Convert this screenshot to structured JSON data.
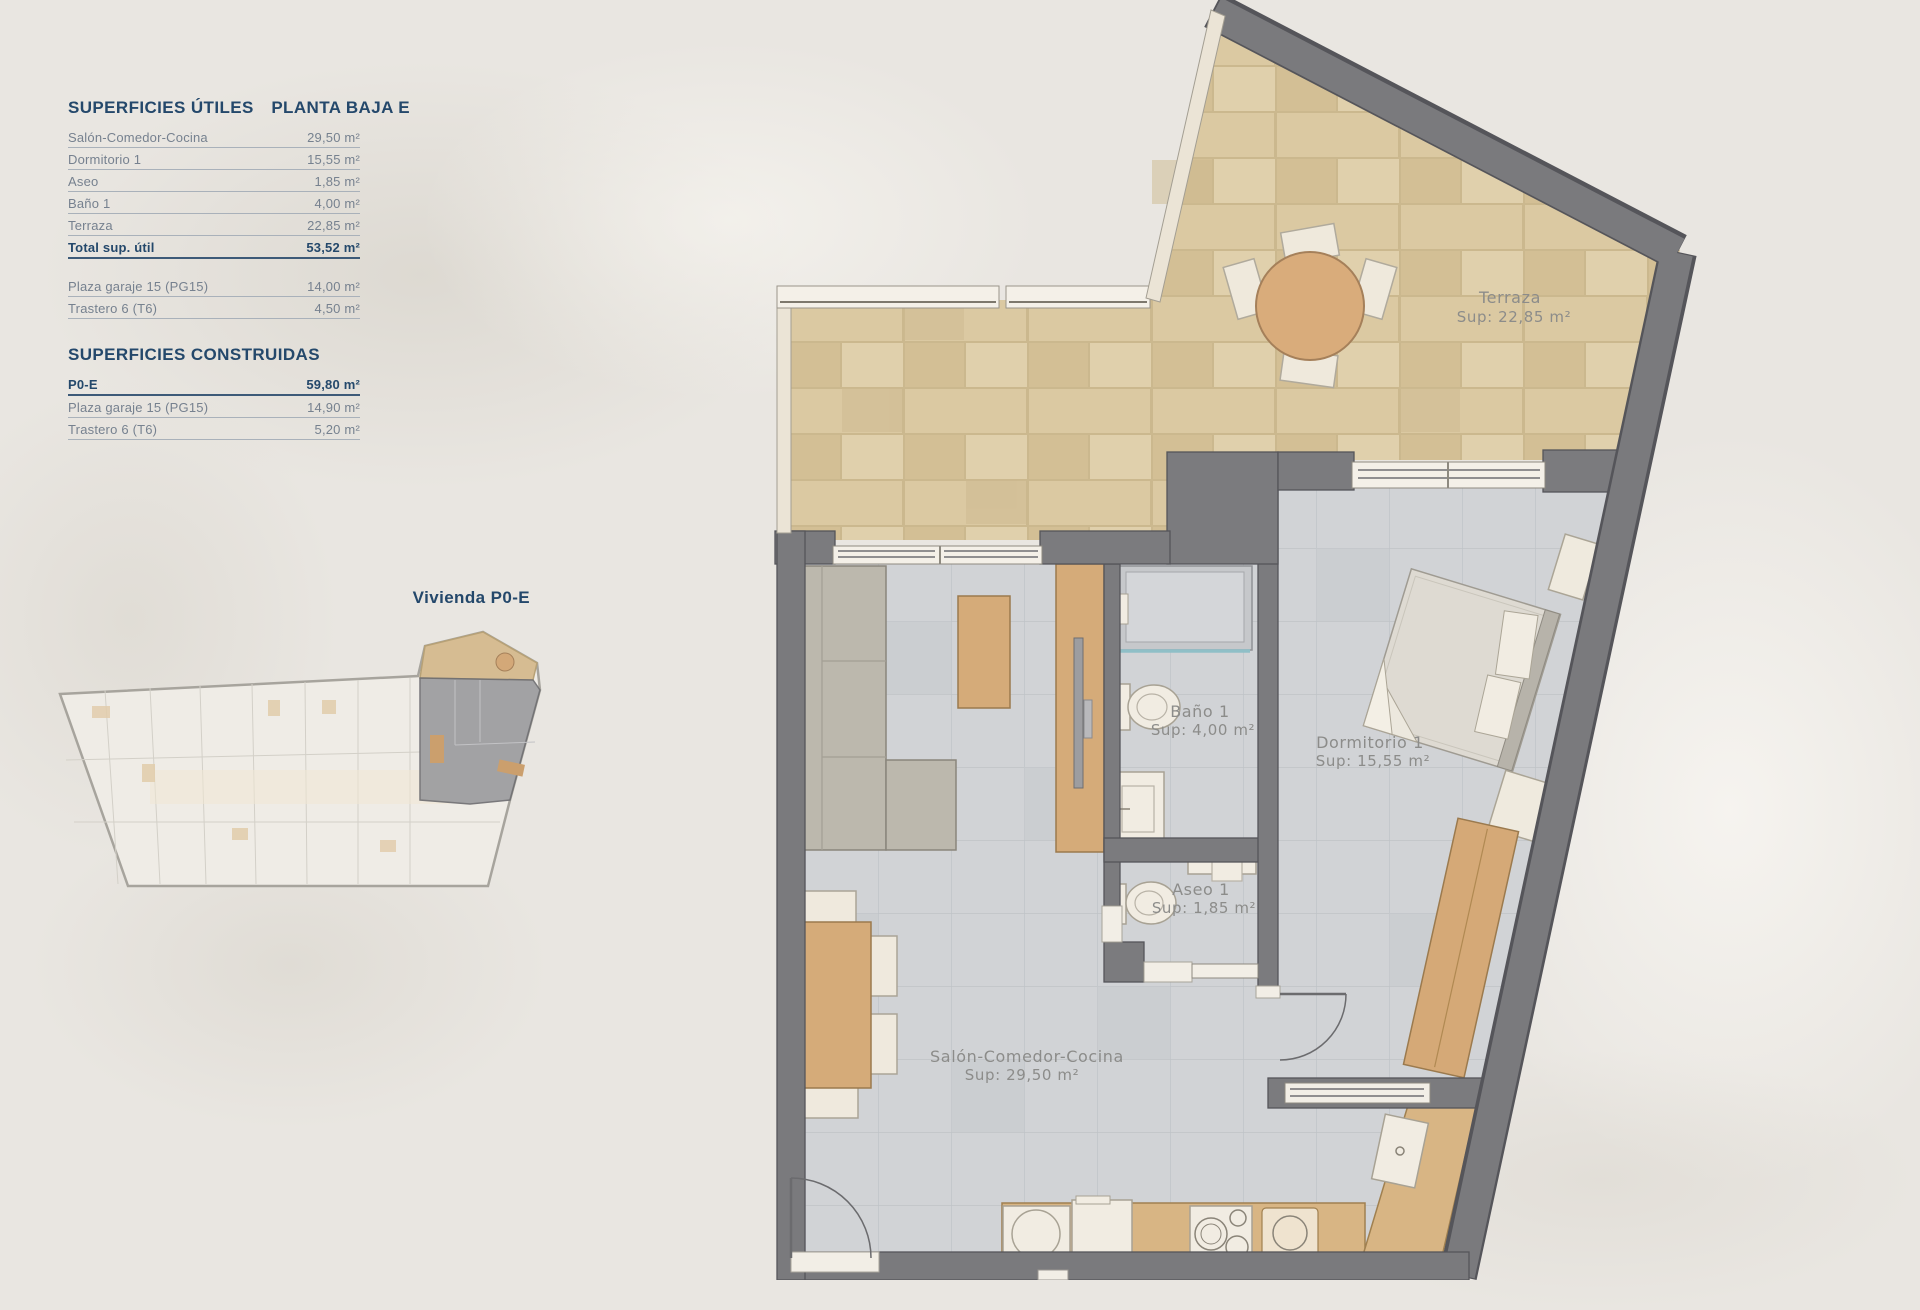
{
  "tables": {
    "utiles": {
      "title": "SUPERFICIES ÚTILES",
      "plan_label": "PLANTA BAJA E",
      "rows": [
        {
          "label": "Salón-Comedor-Cocina",
          "value": "29,50 m²"
        },
        {
          "label": "Dormitorio 1",
          "value": "15,55 m²"
        },
        {
          "label": "Aseo",
          "value": "1,85 m²"
        },
        {
          "label": "Baño 1",
          "value": "4,00 m²"
        },
        {
          "label": "Terraza",
          "value": "22,85 m²"
        }
      ],
      "total": {
        "label": "Total sup. útil",
        "value": "53,52 m²"
      },
      "annex_rows": [
        {
          "label": "Plaza garaje 15 (PG15)",
          "value": "14,00 m²"
        },
        {
          "label": "Trastero 6 (T6)",
          "value": "4,50 m²"
        }
      ]
    },
    "construidas": {
      "title": "SUPERFICIES CONSTRUIDAS",
      "main_row": {
        "label": "P0-E",
        "value": "59,80 m²"
      },
      "rows": [
        {
          "label": "Plaza garaje 15 (PG15)",
          "value": "14,90 m²"
        },
        {
          "label": "Trastero 6 (T6)",
          "value": "5,20 m²"
        }
      ]
    }
  },
  "unit_overview": {
    "caption": "Vivienda P0-E"
  },
  "plan": {
    "rooms": {
      "terraza": {
        "name": "Terraza",
        "area": "Sup: 22,85 m²"
      },
      "banyo": {
        "name": "Baño 1",
        "area": "Sup: 4,00 m²"
      },
      "dormitorio": {
        "name": "Dormitorio 1",
        "area": "Sup: 15,55 m²"
      },
      "aseo": {
        "name": "Aseo 1",
        "area": "Sup: 1,85 m²"
      },
      "salon": {
        "name": "Salón-Comedor-Cocina",
        "area": "Sup: 29,50 m²"
      }
    }
  },
  "colors": {
    "background": "#e9e6e1",
    "accent_navy": "#24486b",
    "row_text": "#76818f",
    "wall_gray": "#7a7a7d",
    "floor_tile": "#d1d3d6",
    "terrace_tile": "#d9c7a0",
    "wood": "#d5ab79",
    "fixture_white": "#f1ece2",
    "shower_glass": "#8fbfc7"
  }
}
